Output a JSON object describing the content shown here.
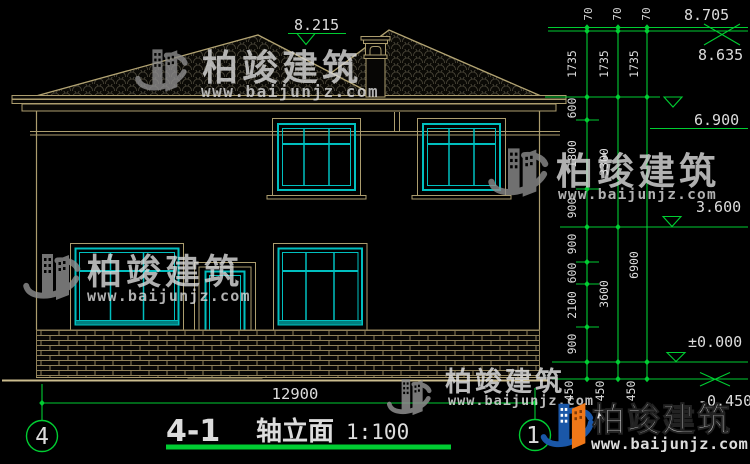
{
  "drawing": {
    "number": "4-1",
    "name": "轴立面",
    "scale": "1:100",
    "width_dim": "12900",
    "grid_left": "4",
    "grid_right": "1"
  },
  "elevations": {
    "roof_minor": "8.215",
    "roof_ridge": "8.705",
    "eave": "8.635",
    "level2": "6.900",
    "level1": "3.600",
    "ground": "±0.000",
    "grade": "-0.450"
  },
  "dims": {
    "top_offsets": [
      "70",
      "70",
      "70"
    ],
    "ridge_runs": [
      "1735",
      "1735",
      "1735"
    ],
    "col_inner": [
      "600",
      "1800",
      "900",
      "900",
      "600",
      "2100",
      "900"
    ],
    "col_middle": [
      "3300",
      "3600"
    ],
    "col_outer": [
      "6900"
    ],
    "grade_offsets": [
      "450",
      "450",
      "450"
    ]
  },
  "watermark": {
    "brand": "柏竣建筑",
    "url": "www.baijunjz.com"
  },
  "colors": {
    "dimension_green": "#00cd32",
    "line_tan": "#ac9d6e",
    "window_cyan": "#00bfbf",
    "text_white": "#dcdcdc",
    "watermark_gray": "#8d8d8d",
    "watermark_dark_red": "#7a1c12",
    "logo_blue": "#1a57a8",
    "logo_orange": "#f07818",
    "url_red": "#c2291f"
  }
}
